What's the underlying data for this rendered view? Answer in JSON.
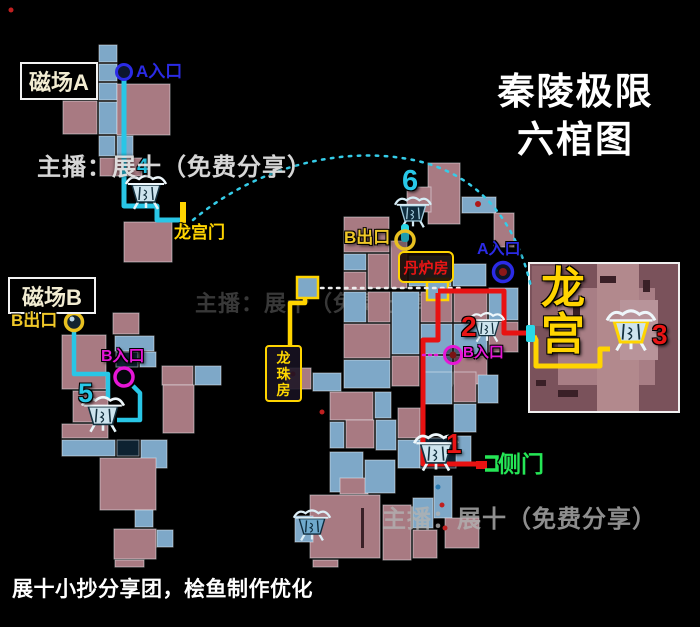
{
  "title": {
    "line1": "秦陵极限",
    "line2": "六棺图"
  },
  "watermarks": {
    "top": "主播：展十（免费分享）",
    "bottom": "主播：展十（免费分享）",
    "faint": "主播：展十（免费分享）"
  },
  "credit": "展十小抄分享团，桧鱼制作优化",
  "boxes": {
    "field_a": {
      "label": "磁场A"
    },
    "field_b": {
      "label": "磁场B"
    },
    "danlufang": {
      "label": "丹炉房"
    },
    "longzhufang": {
      "label": "龙\n珠\n房"
    }
  },
  "labels": [
    {
      "name": "a-entrance-a-label",
      "text": "A入口",
      "x": 136,
      "y": 63,
      "size": 17,
      "color": "#2b2be6"
    },
    {
      "name": "num-4",
      "text": "4",
      "x": 137,
      "y": 156,
      "size": 21,
      "color": "#28c8e8"
    },
    {
      "name": "longgongmen-label",
      "text": "龙宫门",
      "x": 174,
      "y": 224,
      "size": 17,
      "color": "#ffd400"
    },
    {
      "name": "b-exit-b-label",
      "text": "B出口",
      "x": 11,
      "y": 312,
      "size": 17,
      "color": "#f0c828"
    },
    {
      "name": "b-entrance-b-label",
      "text": "B入口",
      "x": 101,
      "y": 349,
      "size": 16,
      "color": "#e616d6"
    },
    {
      "name": "num-5",
      "text": "5",
      "x": 78,
      "y": 379,
      "size": 27,
      "color": "#28c8e8"
    },
    {
      "name": "num-6",
      "text": "6",
      "x": 402,
      "y": 166,
      "size": 29,
      "color": "#28c8e8"
    },
    {
      "name": "b-exit-main-label",
      "text": "B出口",
      "x": 344,
      "y": 229,
      "size": 17,
      "color": "#f0c828"
    },
    {
      "name": "a-entrance-main-label",
      "text": "A入口",
      "x": 477,
      "y": 242,
      "size": 16,
      "color": "#2b2be6"
    },
    {
      "name": "b-entrance-main-label",
      "text": "B入口",
      "x": 463,
      "y": 345,
      "size": 15,
      "color": "#e616d6"
    },
    {
      "name": "num-2",
      "text": "2",
      "x": 461,
      "y": 312,
      "size": 28,
      "color": "#e81515"
    },
    {
      "name": "num-3",
      "text": "3",
      "x": 652,
      "y": 320,
      "size": 28,
      "color": "#e81515"
    },
    {
      "name": "num-1",
      "text": "1",
      "x": 446,
      "y": 429,
      "size": 28,
      "color": "#e81515"
    },
    {
      "name": "cemen-label",
      "text": "侧门",
      "x": 498,
      "y": 452,
      "size": 23,
      "color": "#25e656"
    },
    {
      "name": "palace-label",
      "text": "龙\n宫",
      "x": 541,
      "y": 266,
      "size": 44,
      "color": "#ffd400"
    }
  ],
  "map": {
    "tile_colors": {
      "p": "#a87a82",
      "b": "#7ea8c8",
      "d": "#0d2231"
    },
    "tiles": [
      [
        99,
        45,
        18,
        17,
        "b"
      ],
      [
        99,
        64,
        18,
        17,
        "b"
      ],
      [
        99,
        83,
        18,
        17,
        "b"
      ],
      [
        99,
        102,
        18,
        32,
        "b"
      ],
      [
        63,
        101,
        34,
        33,
        "p"
      ],
      [
        117,
        84,
        53,
        51,
        "p"
      ],
      [
        99,
        136,
        16,
        20,
        "b"
      ],
      [
        117,
        136,
        16,
        20,
        "b"
      ],
      [
        100,
        158,
        42,
        18,
        "p"
      ],
      [
        124,
        222,
        48,
        40,
        "p"
      ],
      [
        113,
        313,
        26,
        21,
        "p"
      ],
      [
        62,
        335,
        44,
        54,
        "p"
      ],
      [
        115,
        336,
        39,
        15,
        "b"
      ],
      [
        116,
        352,
        22,
        15,
        "d"
      ],
      [
        140,
        352,
        16,
        15,
        "b"
      ],
      [
        162,
        366,
        31,
        19,
        "p"
      ],
      [
        195,
        366,
        26,
        19,
        "b"
      ],
      [
        73,
        391,
        35,
        31,
        "p"
      ],
      [
        62,
        424,
        46,
        14,
        "p"
      ],
      [
        62,
        440,
        53,
        16,
        "b"
      ],
      [
        117,
        440,
        22,
        16,
        "d"
      ],
      [
        141,
        440,
        26,
        28,
        "b"
      ],
      [
        100,
        458,
        56,
        52,
        "p"
      ],
      [
        163,
        385,
        31,
        48,
        "p"
      ],
      [
        135,
        510,
        18,
        17,
        "b"
      ],
      [
        114,
        529,
        42,
        30,
        "p"
      ],
      [
        157,
        530,
        16,
        17,
        "b"
      ],
      [
        115,
        560,
        29,
        7,
        "p"
      ],
      [
        313,
        560,
        25,
        7,
        "p"
      ],
      [
        428,
        163,
        32,
        61,
        "p"
      ],
      [
        407,
        187,
        24,
        25,
        "p"
      ],
      [
        462,
        197,
        34,
        16,
        "b"
      ],
      [
        494,
        213,
        20,
        34,
        "p"
      ],
      [
        344,
        217,
        45,
        35,
        "p"
      ],
      [
        344,
        254,
        22,
        16,
        "b"
      ],
      [
        368,
        254,
        21,
        34,
        "p"
      ],
      [
        391,
        241,
        16,
        47,
        "p"
      ],
      [
        344,
        272,
        22,
        18,
        "p"
      ],
      [
        409,
        256,
        42,
        30,
        "b"
      ],
      [
        453,
        264,
        33,
        22,
        "b"
      ],
      [
        344,
        292,
        22,
        30,
        "b"
      ],
      [
        368,
        292,
        22,
        30,
        "p"
      ],
      [
        392,
        292,
        27,
        62,
        "b"
      ],
      [
        421,
        292,
        31,
        30,
        "p"
      ],
      [
        421,
        324,
        31,
        30,
        "b"
      ],
      [
        454,
        292,
        33,
        30,
        "p"
      ],
      [
        454,
        324,
        33,
        30,
        "b"
      ],
      [
        489,
        288,
        29,
        32,
        "b"
      ],
      [
        489,
        322,
        29,
        30,
        "p"
      ],
      [
        344,
        324,
        46,
        34,
        "p"
      ],
      [
        344,
        360,
        46,
        28,
        "b"
      ],
      [
        392,
        356,
        27,
        30,
        "p"
      ],
      [
        421,
        356,
        31,
        30,
        "b"
      ],
      [
        454,
        356,
        33,
        28,
        "p"
      ],
      [
        287,
        368,
        24,
        21,
        "p"
      ],
      [
        313,
        373,
        28,
        18,
        "b"
      ],
      [
        330,
        392,
        43,
        28,
        "p"
      ],
      [
        375,
        392,
        16,
        26,
        "b"
      ],
      [
        330,
        422,
        14,
        26,
        "b"
      ],
      [
        346,
        420,
        28,
        28,
        "p"
      ],
      [
        376,
        420,
        20,
        30,
        "b"
      ],
      [
        398,
        408,
        22,
        30,
        "p"
      ],
      [
        398,
        440,
        22,
        28,
        "b"
      ],
      [
        422,
        372,
        30,
        32,
        "b"
      ],
      [
        454,
        372,
        22,
        30,
        "p"
      ],
      [
        478,
        375,
        20,
        28,
        "b"
      ],
      [
        454,
        404,
        22,
        28,
        "b"
      ],
      [
        455,
        436,
        16,
        26,
        "b"
      ],
      [
        420,
        438,
        36,
        30,
        "d"
      ],
      [
        330,
        452,
        33,
        40,
        "b"
      ],
      [
        340,
        478,
        28,
        16,
        "p"
      ],
      [
        365,
        460,
        30,
        33,
        "b"
      ],
      [
        310,
        495,
        70,
        63,
        "p"
      ],
      [
        295,
        516,
        18,
        26,
        "b"
      ],
      [
        383,
        505,
        28,
        55,
        "p"
      ],
      [
        413,
        498,
        20,
        30,
        "b"
      ],
      [
        434,
        476,
        18,
        42,
        "b"
      ],
      [
        445,
        518,
        34,
        30,
        "p"
      ],
      [
        413,
        530,
        24,
        28,
        "p"
      ]
    ],
    "palace": {
      "border": [
        529,
        263,
        150,
        149
      ],
      "shapes": [
        [
          530,
          264,
          148,
          147,
          "#7a525b"
        ],
        [
          532,
          266,
          28,
          60,
          "#8f636b"
        ],
        [
          558,
          288,
          97,
          97,
          "#a87e85"
        ],
        [
          597,
          264,
          42,
          147,
          "#b2898d"
        ],
        [
          620,
          300,
          38,
          60,
          "#b8949a"
        ],
        [
          600,
          276,
          16,
          7,
          "#3a2027"
        ],
        [
          573,
          300,
          7,
          16,
          "#3a2027"
        ],
        [
          558,
          390,
          20,
          7,
          "#3a2027"
        ],
        [
          643,
          280,
          7,
          12,
          "#3a2027"
        ],
        [
          536,
          380,
          10,
          6,
          "#3a2027"
        ],
        [
          361,
          508,
          3,
          40,
          "#3a2027"
        ]
      ]
    },
    "junction_color": "#ffd400",
    "junctions": [
      [
        297,
        277,
        21,
        21
      ],
      [
        427,
        279,
        21,
        21
      ]
    ],
    "paths": [
      {
        "name": "route-a-to-longgongmen",
        "color": "#29c6e6",
        "width": 5,
        "points": [
          [
            124,
            80
          ],
          [
            124,
            206
          ],
          [
            157,
            206
          ],
          [
            157,
            220
          ],
          [
            181,
            220
          ]
        ]
      },
      {
        "name": "route-dotted-arc",
        "color": "#35cce8",
        "width": 2.5,
        "dash": "2.5 6.5",
        "d": "M193,220 C255,168 335,148 402,158 C472,168 515,215 531,287"
      },
      {
        "name": "route-dotted-white",
        "color": "#eeeeee",
        "width": 2.5,
        "dash": "2.5 5.5",
        "points": [
          [
            321,
            288
          ],
          [
            465,
            288
          ]
        ]
      },
      {
        "name": "route-yellow-longzhufang",
        "color": "#ffd400",
        "width": 4.5,
        "points": [
          [
            305,
            297
          ],
          [
            305,
            303
          ],
          [
            290,
            303
          ],
          [
            290,
            346
          ]
        ]
      },
      {
        "name": "route-red-coffin2",
        "color": "#e81212",
        "width": 5,
        "points": [
          [
            438,
            291
          ],
          [
            504,
            291
          ],
          [
            504,
            333
          ],
          [
            527,
            333
          ]
        ]
      },
      {
        "name": "route-yellow-coffin3",
        "color": "#ffd400",
        "width": 5,
        "points": [
          [
            534,
            336
          ],
          [
            536,
            340
          ],
          [
            536,
            366
          ],
          [
            600,
            366
          ],
          [
            600,
            349
          ],
          [
            610,
            349
          ]
        ]
      },
      {
        "name": "route-red-coffin1-cemen",
        "color": "#e81212",
        "width": 5,
        "points": [
          [
            438,
            293
          ],
          [
            438,
            340
          ],
          [
            423,
            340
          ],
          [
            423,
            464
          ],
          [
            479,
            464
          ]
        ]
      },
      {
        "name": "route-b-exit-to-coffin5",
        "color": "#29c6e6",
        "width": 4.5,
        "points": [
          [
            74,
            330
          ],
          [
            74,
            374
          ],
          [
            108,
            374
          ],
          [
            108,
            398
          ]
        ]
      },
      {
        "name": "route-b-entrance-to-coffin5",
        "color": "#29c6e6",
        "width": 4.5,
        "points": [
          [
            133,
            386
          ],
          [
            140,
            393
          ],
          [
            140,
            420
          ],
          [
            117,
            420
          ]
        ]
      },
      {
        "name": "route-dotted-magenta",
        "color": "#e616d6",
        "width": 2.5,
        "dash": "2 4",
        "points": [
          [
            423,
            355
          ],
          [
            441,
            355
          ]
        ]
      }
    ],
    "markers": [
      {
        "name": "longgongmen-door-bar",
        "type": "rect",
        "rect": [
          180,
          202,
          6,
          31
        ],
        "color": "#ffd400"
      },
      {
        "name": "coffin2-exit-tick",
        "type": "rect",
        "rect": [
          526,
          325,
          9,
          17
        ],
        "color": "#2ad8e8",
        "rx": 2
      },
      {
        "name": "pillar-b-exit-main",
        "type": "rect",
        "rect": [
          401,
          224,
          8,
          18
        ],
        "color": "#2ad8e8",
        "rx": 3
      },
      {
        "name": "cemen-door-red",
        "type": "rect",
        "rect": [
          476,
          461,
          11,
          8
        ],
        "color": "#e81212"
      },
      {
        "name": "cemen-door-green",
        "type": "path",
        "d": "M485,457 H497 V470 H485",
        "color": "#25e656",
        "width": 3.5
      },
      {
        "name": "red-dot-tile",
        "type": "dot",
        "x": 478,
        "y": 204,
        "r": 3,
        "color": "#b01818"
      },
      {
        "name": "corner-dot",
        "type": "dot",
        "x": 11,
        "y": 10,
        "r": 2.5,
        "color": "#c02020"
      },
      {
        "name": "red-diamond-1",
        "type": "dot",
        "x": 293,
        "y": 374,
        "r": 2.5,
        "color": "#c02020"
      },
      {
        "name": "red-diamond-2",
        "type": "dot",
        "x": 322,
        "y": 412,
        "r": 2.5,
        "color": "#c02020"
      },
      {
        "name": "red-diamond-3",
        "type": "dot",
        "x": 442,
        "y": 505,
        "r": 2.5,
        "color": "#c02020"
      },
      {
        "name": "red-diamond-4",
        "type": "dot",
        "x": 445,
        "y": 528,
        "r": 2.5,
        "color": "#c02020"
      },
      {
        "name": "blue-diamond",
        "type": "dot",
        "x": 438,
        "y": 487,
        "r": 2.5,
        "color": "#2a7ab0"
      }
    ],
    "circles": [
      {
        "name": "a-entrance-a-circle",
        "x": 124,
        "y": 72,
        "r": 7.5,
        "stroke": "#2b2be6",
        "width": 3,
        "fill": "#0c1630"
      },
      {
        "name": "b-exit-b-circle",
        "x": 74,
        "y": 322,
        "r": 8.5,
        "stroke": "#e8c020",
        "width": 3.5,
        "fill": "#13232f",
        "dot": {
          "r": 2.5,
          "color": "#bcd8e8",
          "dx": -2,
          "dy": -3
        }
      },
      {
        "name": "b-entrance-b-circle",
        "x": 124,
        "y": 377,
        "r": 9,
        "stroke": "#e616d6",
        "width": 3.5,
        "fill": "rgba(8,12,20,0.55)"
      },
      {
        "name": "b-exit-main-circle",
        "x": 405,
        "y": 240,
        "r": 9,
        "stroke": "#e8c020",
        "width": 3.5,
        "fill": "rgba(10,20,30,0.3)"
      },
      {
        "name": "a-entrance-main-circle",
        "x": 503,
        "y": 272,
        "r": 9.5,
        "stroke": "#2b2be6",
        "width": 3.5,
        "fill": "#0b1426",
        "dot": {
          "r": 4,
          "color": "#8a1818",
          "dx": 0,
          "dy": 0
        }
      },
      {
        "name": "b-entrance-main-circle",
        "x": 453,
        "y": 355,
        "r": 8.5,
        "stroke": "#e616d6",
        "width": 3,
        "fill": "rgba(10,8,14,0.5)",
        "dot": {
          "r": 3.5,
          "color": "#7a1414",
          "dx": 0,
          "dy": 0
        }
      }
    ],
    "coffins": [
      {
        "name": "coffin-4",
        "x": 124,
        "y": 172,
        "w": 44,
        "h": 40,
        "variant": "light"
      },
      {
        "name": "coffin-5",
        "x": 80,
        "y": 393,
        "w": 46,
        "h": 42,
        "variant": "light"
      },
      {
        "name": "coffin-6",
        "x": 390,
        "y": 194,
        "w": 46,
        "h": 36,
        "variant": "dark"
      },
      {
        "name": "coffin-2",
        "x": 468,
        "y": 308,
        "w": 38,
        "h": 38,
        "variant": "light"
      },
      {
        "name": "coffin-3",
        "x": 604,
        "y": 306,
        "w": 54,
        "h": 48,
        "variant": "gold"
      },
      {
        "name": "coffin-1",
        "x": 412,
        "y": 430,
        "w": 48,
        "h": 44,
        "variant": "light"
      },
      {
        "name": "coffin-extra",
        "x": 292,
        "y": 506,
        "w": 40,
        "h": 38,
        "variant": "blue"
      }
    ]
  }
}
